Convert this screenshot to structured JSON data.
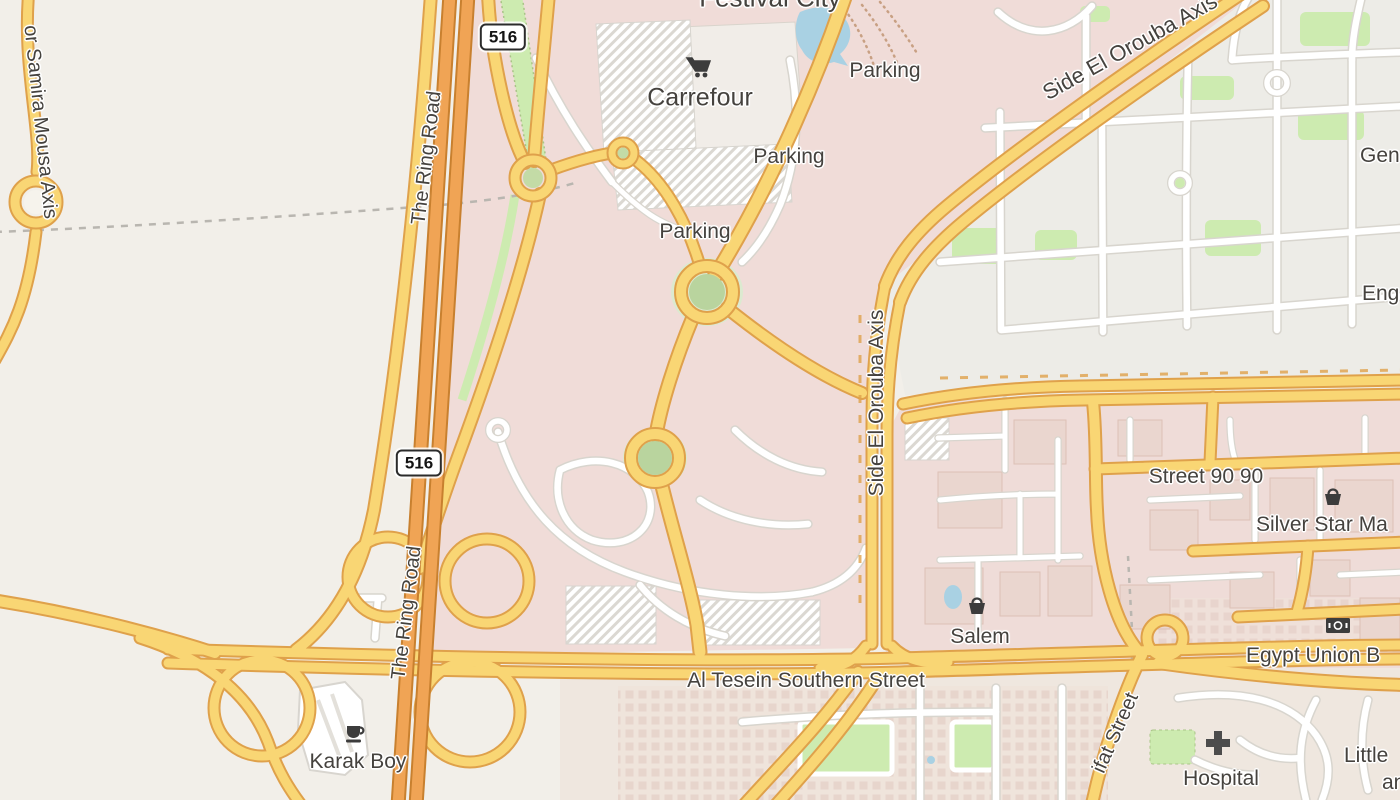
{
  "palette": {
    "background": "#f2efe9",
    "retail_area": "#f0dcd8",
    "residential_area": "#edece7",
    "commercial_blocks": "#efdcd8",
    "road_yellow": "#f9d674",
    "road_yellow_casing": "#dfa14b",
    "road_orange_trunk": "#f0a455",
    "road_orange_casing": "#c8802f",
    "road_minor": "#ffffff",
    "grass": "#cdebb0",
    "water": "#a9d1e3",
    "label_text": "#45423e",
    "icon_color": "#3c3c3c"
  },
  "shields": {
    "ring_road_north": "516",
    "ring_road_south": "516"
  },
  "roads": {
    "ring_road_n": "The Ring Road",
    "ring_road_s": "The Ring Road",
    "samira": "or Samira Mousa Axis",
    "orouba_diag": "Side El Orouba Axis",
    "orouba_vert": "Side El Orouba Axis",
    "street_90_90": "Street 90 90",
    "al_tesein": "Al Tesein Southern Street",
    "egypt_union": "Egypt Union B",
    "ifat": "ifat Street"
  },
  "places": {
    "festival_city": "Festival City",
    "carrefour": "Carrefour",
    "parking_n": "Parking",
    "parking_mid": "Parking",
    "parking_s": "Parking",
    "silver_star": "Silver Star Ma",
    "salem": "Salem",
    "karak_boy": "Karak Boy",
    "hospital": "Hospital",
    "little_1": "Little",
    "little_2": "an",
    "gen": "Gen",
    "eng": "Eng"
  },
  "icons": {
    "carrefour": "shopping-cart",
    "salem": "shopping-basket",
    "silver_star": "shopping-basket",
    "karak_boy": "coffee-cup",
    "hospital": "medical-cross",
    "egypt_union": "banknote"
  }
}
